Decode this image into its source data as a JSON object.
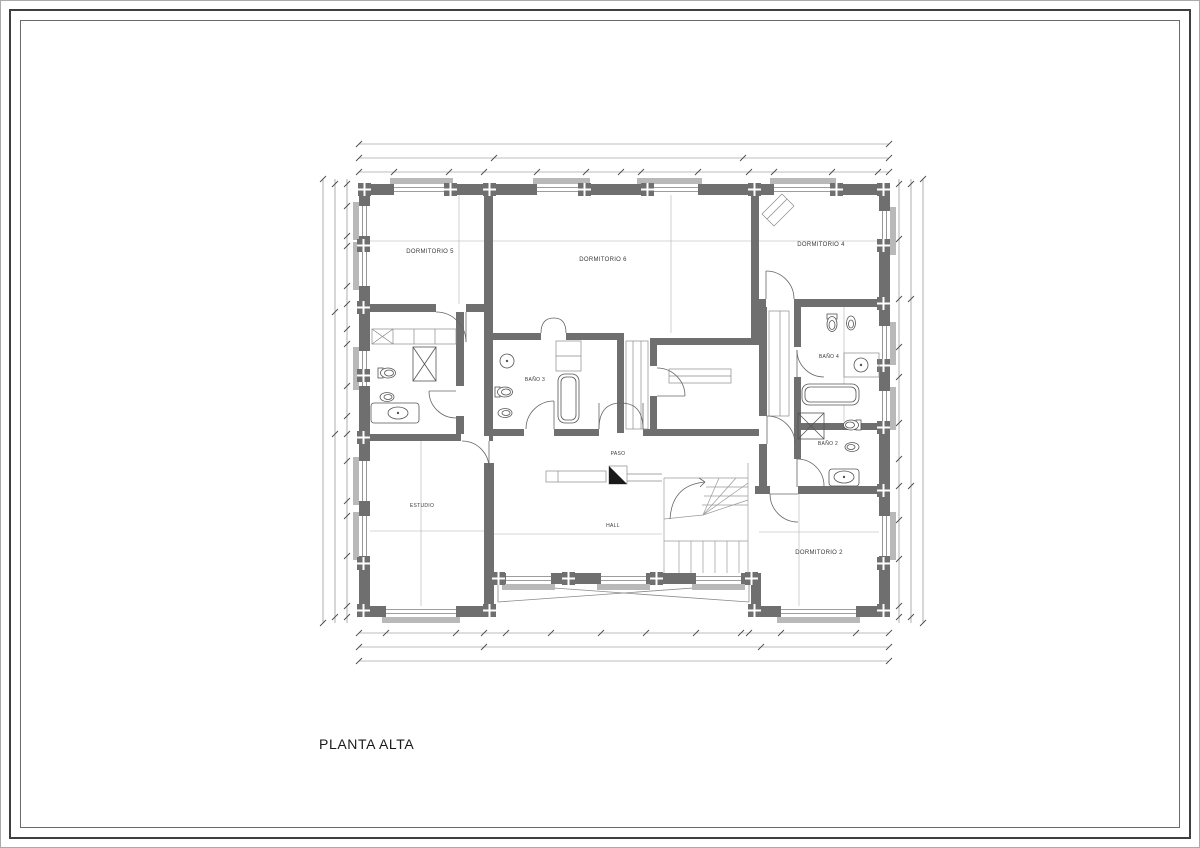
{
  "page": {
    "title": "PLANTA ALTA"
  },
  "plan": {
    "rooms": [
      {
        "label": "DORMITORIO 5"
      },
      {
        "label": "DORMITORIO 6"
      },
      {
        "label": "DORMITORIO 4"
      },
      {
        "label": "BAÑO 3"
      },
      {
        "label": "BAÑO 4"
      },
      {
        "label": "BAÑO 2"
      },
      {
        "label": "PASO"
      },
      {
        "label": "HALL"
      },
      {
        "label": "ESTUDIO"
      },
      {
        "label": "DORMITORIO 2"
      }
    ],
    "colors": {
      "wall": "#6f6f6f",
      "line": "#555555",
      "sill": "#b9b9b9",
      "background": "#ffffff",
      "dimension": "#7a7a7a",
      "label": "#3a3a3a"
    }
  }
}
